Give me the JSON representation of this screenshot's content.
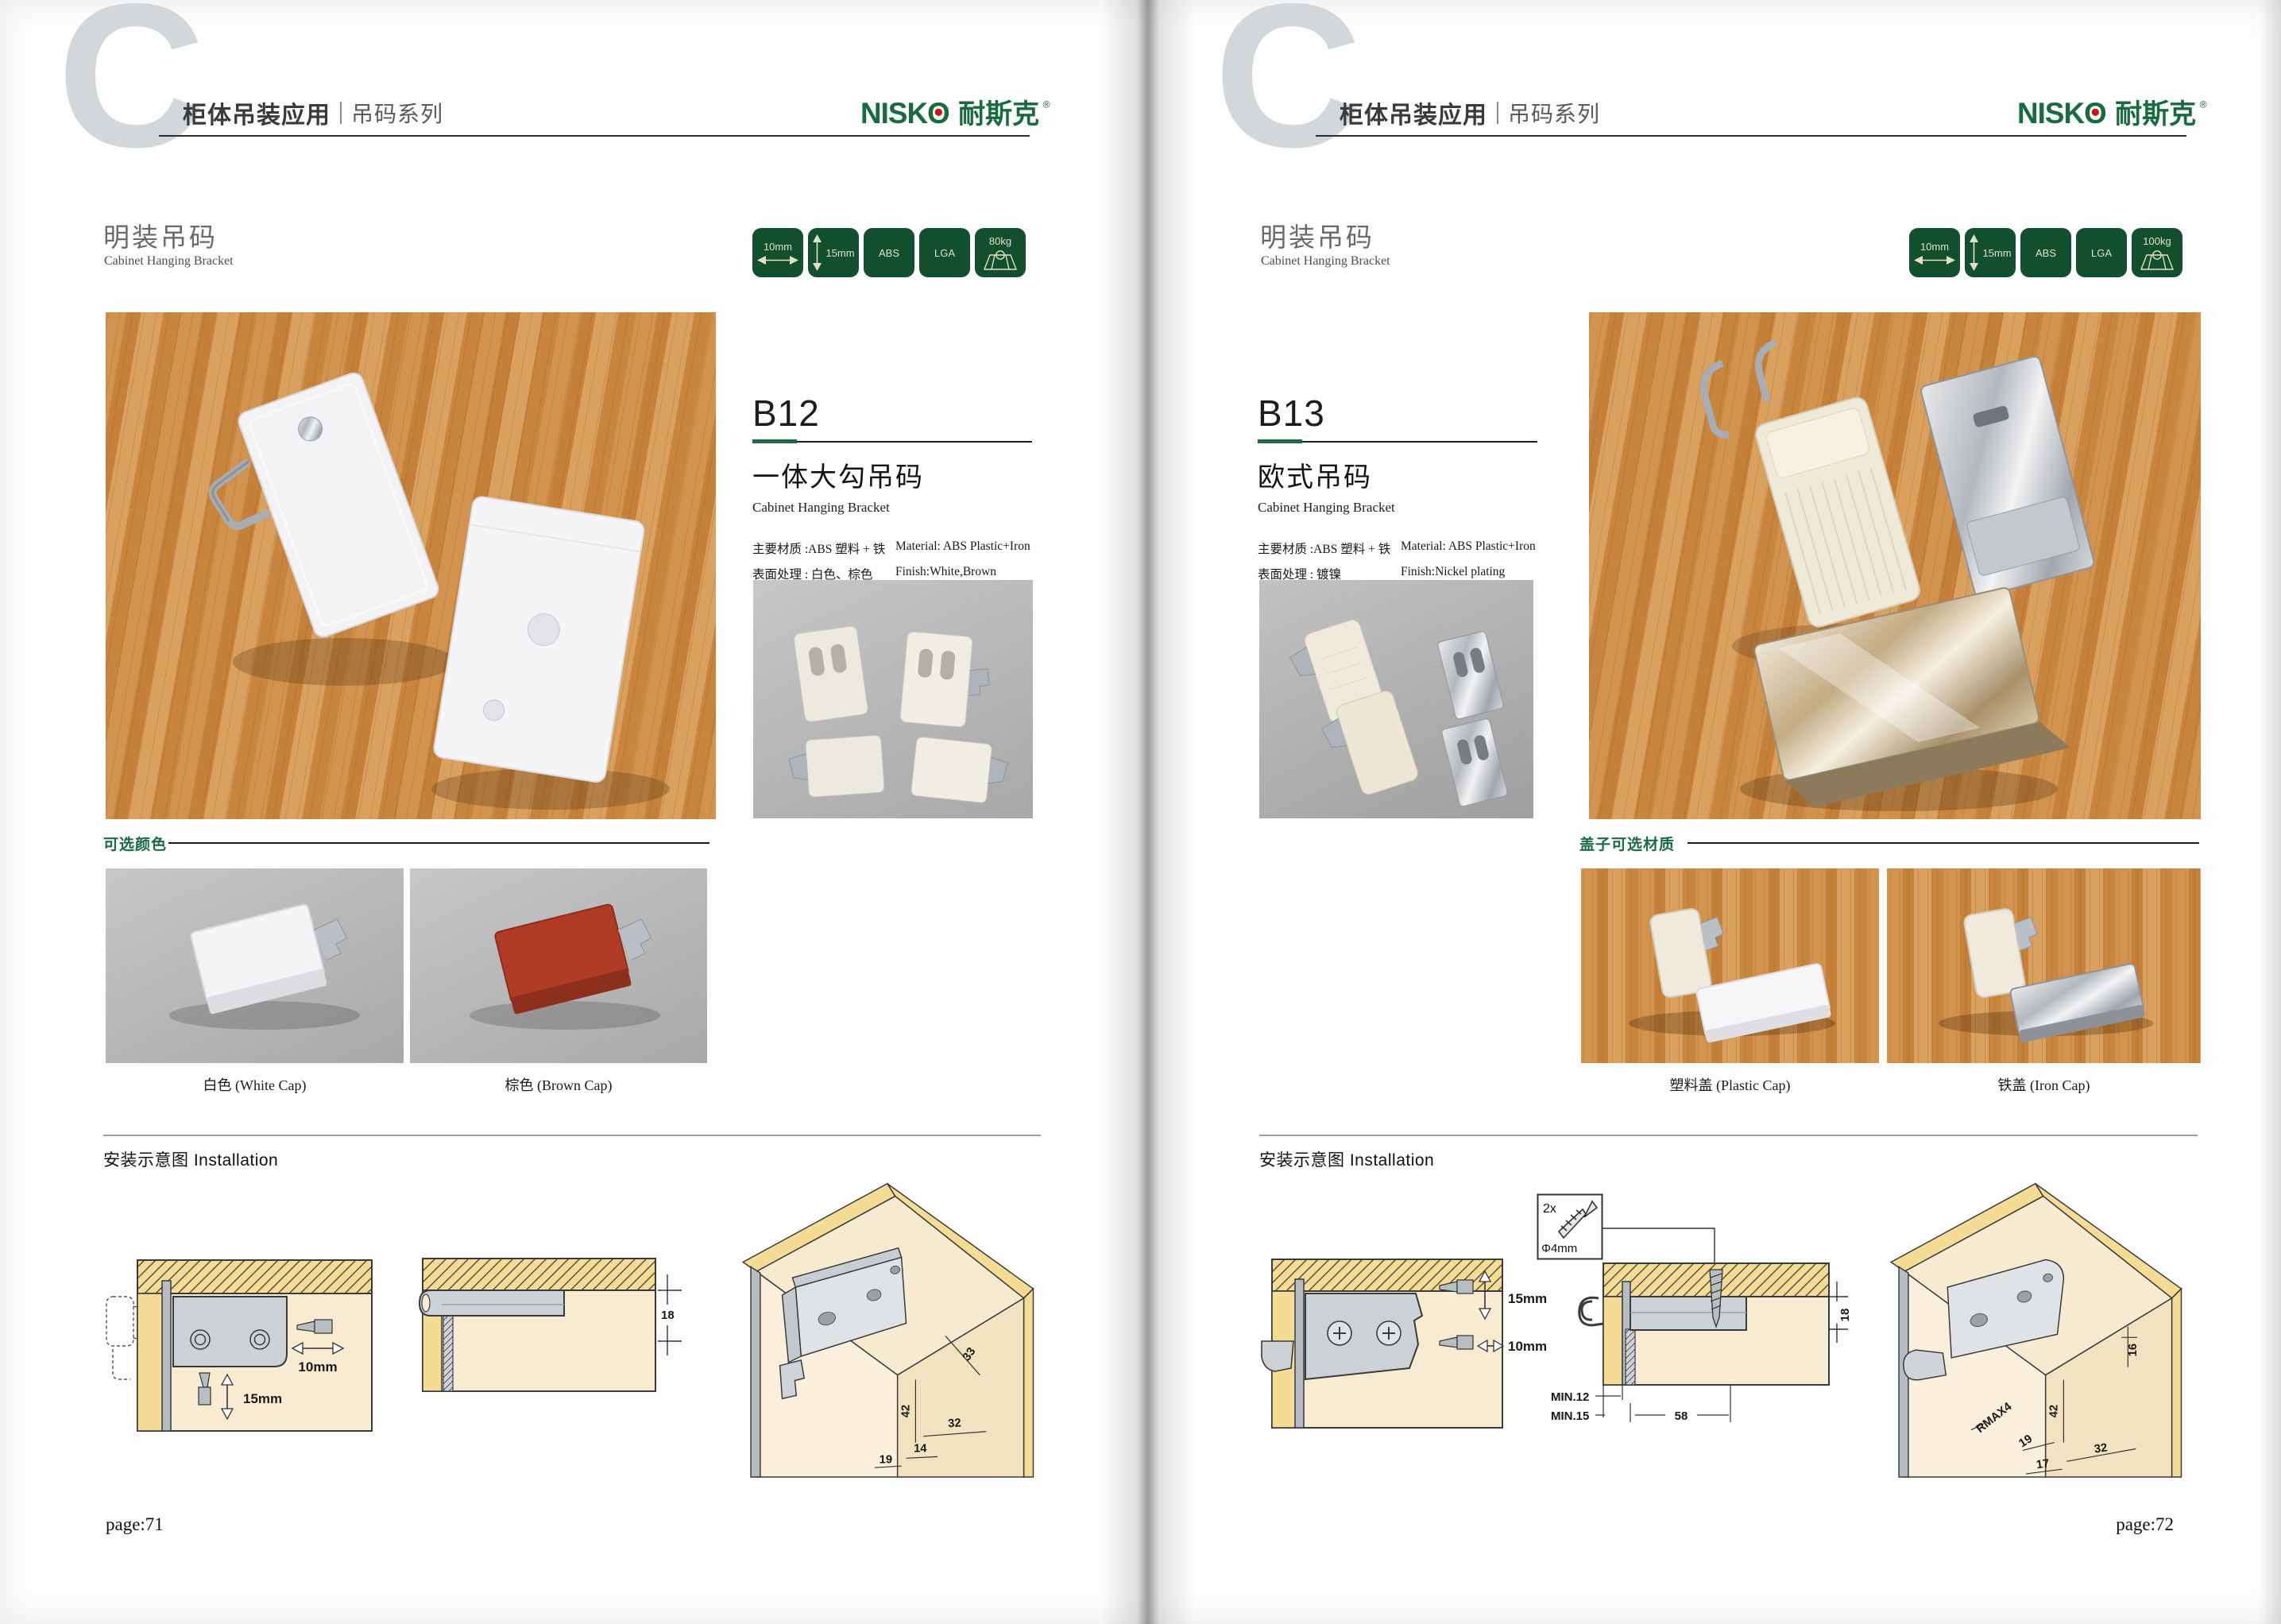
{
  "brand": {
    "logo_text": "NISKO",
    "logo_cn": "耐斯克",
    "reg": "®"
  },
  "colors": {
    "badge_green": "#124f2e",
    "accent_green": "#1a6b45",
    "logo_green": "#186b3f",
    "logo_dot_red": "#cc1111"
  },
  "left": {
    "letter": "C",
    "header": {
      "bold": "柜体吊装应用",
      "light": "吊码系列"
    },
    "section": {
      "cn": "明装吊码",
      "en": "Cabinet Hanging Bracket"
    },
    "badges": {
      "width": "10mm",
      "height": "15mm",
      "material": "ABS",
      "cert": "LGA",
      "load": "80kg"
    },
    "product": {
      "code": "B12",
      "name_cn": "一体大勾吊码",
      "name_en": "Cabinet Hanging Bracket",
      "spec1_cn": "主要材质 :ABS 塑料 + 铁",
      "spec1_en": "Material: ABS Plastic+Iron",
      "spec2_cn": "表面处理 : 白色、棕色",
      "spec2_en": "Finish:White,Brown"
    },
    "options": {
      "label": "可选颜色",
      "cap1": "白色 (White Cap)",
      "cap2": "棕色 (Brown Cap)"
    },
    "install": {
      "label": "安装示意图 Installation",
      "d1_w": "10mm",
      "d1_h": "15mm",
      "d2_dim": "18",
      "d3_a": "33",
      "d3_b": "42",
      "d3_c": "32",
      "d3_d": "14",
      "d3_e": "19"
    },
    "page_no": "page:71"
  },
  "right": {
    "letter": "C",
    "header": {
      "bold": "柜体吊装应用",
      "light": "吊码系列"
    },
    "section": {
      "cn": "明装吊码",
      "en": "Cabinet Hanging Bracket"
    },
    "badges": {
      "width": "10mm",
      "height": "15mm",
      "material": "ABS",
      "cert": "LGA",
      "load": "100kg"
    },
    "product": {
      "code": "B13",
      "name_cn": "欧式吊码",
      "name_en": "Cabinet Hanging Bracket",
      "spec1_cn": "主要材质 :ABS 塑料 + 铁",
      "spec1_en": "Material: ABS Plastic+Iron",
      "spec2_cn": "表面处理 : 镀镍",
      "spec2_en": "Finish:Nickel plating"
    },
    "options": {
      "label": "盖子可选材质",
      "cap1": "塑料盖 (Plastic Cap)",
      "cap2": "铁盖 (Iron Cap)"
    },
    "install": {
      "label": "安装示意图 Installation",
      "screw_qty": "2x",
      "screw_dia": "Φ4mm",
      "d1_h": "15mm",
      "d1_w": "10mm",
      "d2_dim": "18",
      "d2_min1": "MIN.12",
      "d2_min2": "MIN.15",
      "d2_len": "58",
      "d3_a": "16",
      "d3_b": "42",
      "d3_c": "RMAX4",
      "d3_d": "19",
      "d3_e": "17",
      "d3_f": "32"
    },
    "page_no": "page:72"
  }
}
